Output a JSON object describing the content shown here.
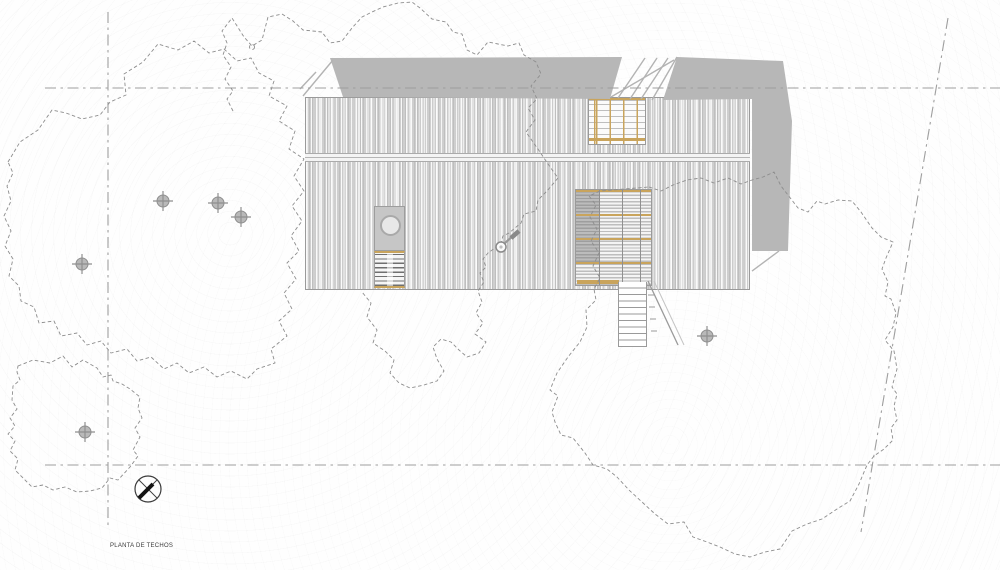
{
  "title": {
    "label": "PLANTA DE TECHOS"
  },
  "colors": {
    "paper": "#fefefe",
    "roof_base": "#dcdcdc",
    "shadow": "#b7b7b7",
    "wood_accent": "#c9a45c",
    "boundary_line": "#9e9e9e",
    "tree_outline": "#8d8d8d",
    "detail_line": "#9a9a9a",
    "compass_ink": "#3b3b3b",
    "north_needle": "#141414"
  }
}
